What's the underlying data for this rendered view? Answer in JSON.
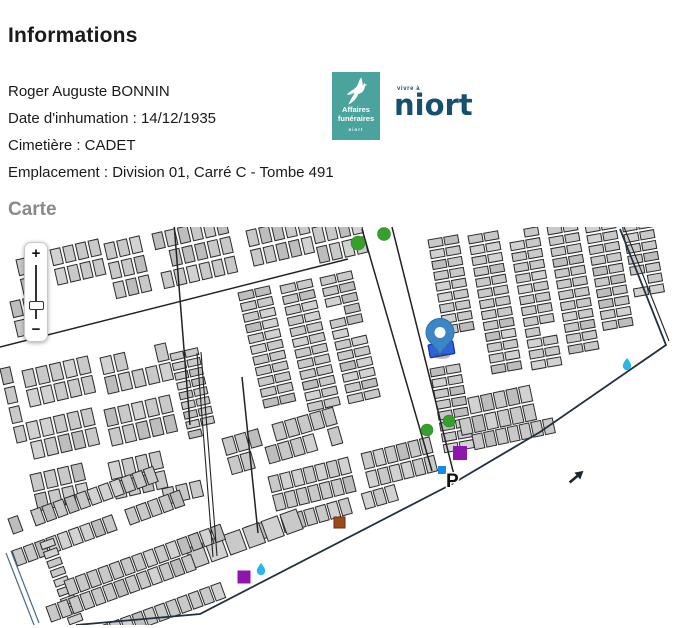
{
  "header": {
    "title": "Informations"
  },
  "info": {
    "name": "Roger Auguste BONNIN",
    "lines": [
      "Date d'inhumation : 14/12/1935",
      "Cimetière : CADET",
      "Emplacement : Division 01, Carré C - Tombe 491"
    ]
  },
  "logos": {
    "affaires_funeraires": {
      "line1": "Affaires",
      "line2": "funéraires",
      "footer": "niort",
      "bg_color": "#4ba39d"
    },
    "niort": {
      "tagline": "vivre à",
      "word": "niort",
      "color": "#15506f"
    }
  },
  "map": {
    "heading": "Carte",
    "zoom_in": "+",
    "zoom_out": "−",
    "parking_label": "P",
    "colors": {
      "pin": "#3d86c6",
      "pin_stroke": "#2f6ea8",
      "selected_plot": "#2f63de",
      "plot_fill": "#c9c9c9",
      "plot_stroke": "#2b2b2b",
      "tree": "#35a02a",
      "water": "#29b6e8",
      "purple_poi": "#8d17ad",
      "brown_poi": "#9c4a1a",
      "blue_poi": "#1e88e5",
      "boundary": "#22303f"
    }
  }
}
